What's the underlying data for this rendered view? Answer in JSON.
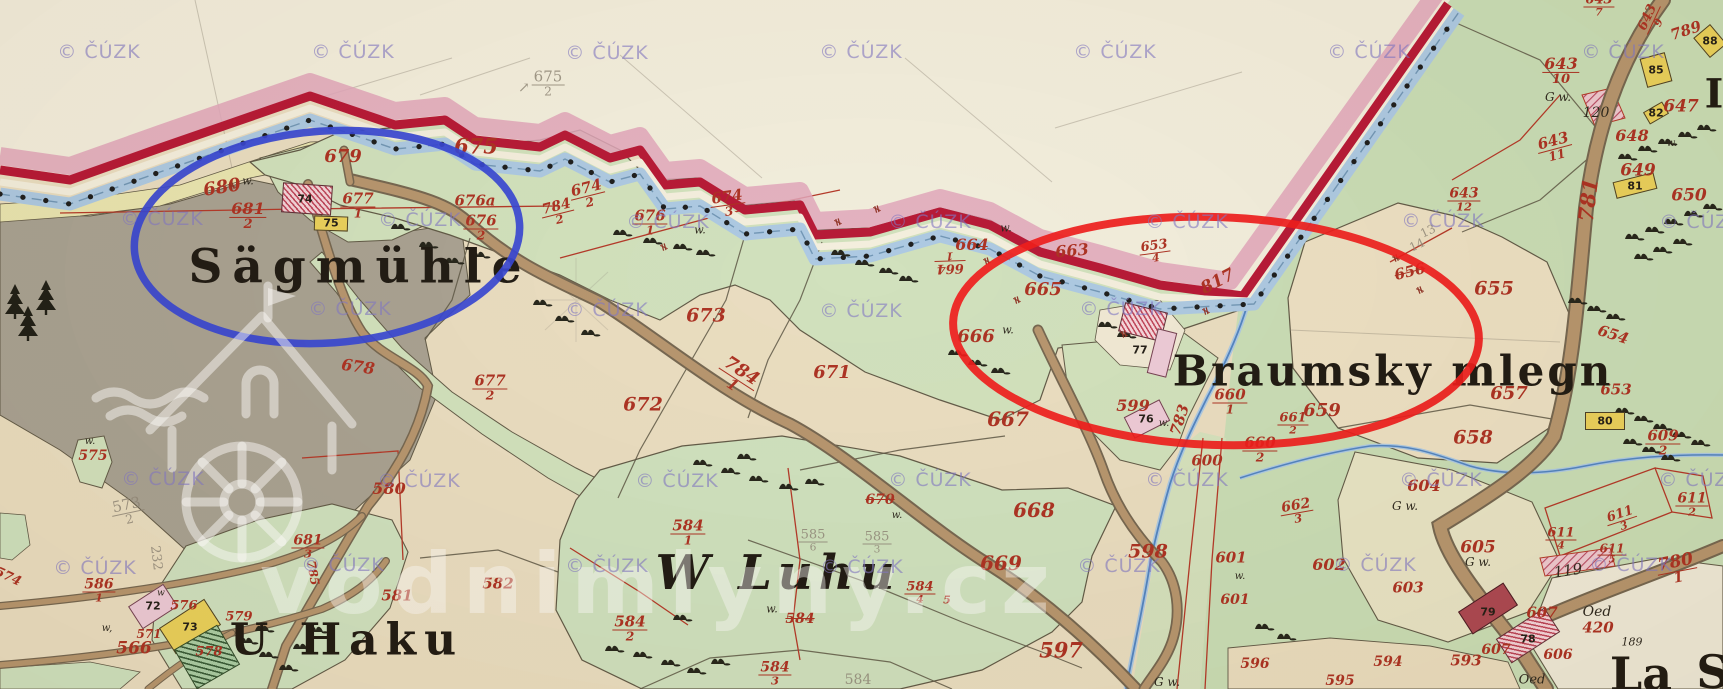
{
  "map": {
    "description": "historical cadastral map sheet with stream boundary, meadows, roads and farmsteads"
  },
  "watermark": {
    "copyright": "© ČÚZK",
    "site": "vodnimlyny.cz",
    "copyright_positions": [
      [
        99,
        52
      ],
      [
        353,
        52
      ],
      [
        607,
        53
      ],
      [
        861,
        52
      ],
      [
        1115,
        52
      ],
      [
        1369,
        52
      ],
      [
        1623,
        52
      ],
      [
        162,
        219
      ],
      [
        420,
        220
      ],
      [
        668,
        222
      ],
      [
        930,
        222
      ],
      [
        1187,
        222
      ],
      [
        1443,
        221
      ],
      [
        1701,
        222
      ],
      [
        350,
        309
      ],
      [
        607,
        310
      ],
      [
        861,
        311
      ],
      [
        1121,
        309
      ],
      [
        163,
        479
      ],
      [
        419,
        481
      ],
      [
        677,
        481
      ],
      [
        930,
        480
      ],
      [
        1187,
        480
      ],
      [
        1441,
        480
      ],
      [
        1700,
        480
      ],
      [
        95,
        568
      ],
      [
        343,
        565
      ],
      [
        607,
        566
      ],
      [
        862,
        567
      ],
      [
        1119,
        566
      ],
      [
        1375,
        565
      ],
      [
        1631,
        565
      ]
    ]
  },
  "annotations": {
    "blue_ellipse": {
      "cx": 327,
      "cy": 237,
      "rx": 193,
      "ry": 106,
      "rot": -4,
      "color": "#2e3ed2",
      "width": 7.5
    },
    "red_ellipse": {
      "cx": 1216,
      "cy": 331,
      "rx": 263,
      "ry": 114,
      "rot": 2,
      "color": "#ee1212",
      "width": 8
    }
  },
  "colors": {
    "paper_outside": "#f2eddc",
    "paper_field": "#e9dcbf",
    "meadow_green": "#cfe0bb",
    "village_green": "#c7dcb4",
    "forest_gray": "#a59e8f",
    "boundary_crimson": "#b30f2e",
    "boundary_pink": "#dfa2b8",
    "stream_blue": "#a9c7e2",
    "road_brown": "#b39169",
    "parcel_red": "#a8291a",
    "pencil_gray": "#8b8374",
    "ink_black": "#221d14"
  },
  "place_names": [
    {
      "text": "Sägmühle",
      "x": 360,
      "y": 267,
      "size": 47,
      "ls": 10
    },
    {
      "text": "Braumsky mlegn",
      "x": 1393,
      "y": 371,
      "size": 42,
      "ls": 3
    },
    {
      "text": "U Haku",
      "x": 347,
      "y": 640,
      "size": 44,
      "ls": 8
    },
    {
      "text": "W Luhu",
      "x": 778,
      "y": 573,
      "size": 48,
      "ls": 6,
      "style": "script"
    },
    {
      "text": "La",
      "x": 1641,
      "y": 674,
      "size": 46
    },
    {
      "text": "S",
      "x": 1713,
      "y": 672,
      "size": 46
    },
    {
      "text": "I",
      "x": 1714,
      "y": 94,
      "size": 40
    }
  ],
  "parcel_labels": [
    {
      "n": "675",
      "d": "2",
      "x": 548,
      "y": 84,
      "c": "pencil",
      "s": 15
    },
    {
      "t": "↗",
      "x": 524,
      "y": 88,
      "c": "pencil",
      "s": 14
    },
    {
      "t": "675",
      "x": 476,
      "y": 146,
      "s": 21
    },
    {
      "t": "679",
      "x": 343,
      "y": 157,
      "s": 18
    },
    {
      "t": "680",
      "x": 222,
      "y": 188,
      "r": -9,
      "s": 18
    },
    {
      "t": "w.",
      "x": 248,
      "y": 181,
      "c": "black",
      "s": 11
    },
    {
      "n": "681",
      "d": "2",
      "x": 248,
      "y": 216,
      "s": 16
    },
    {
      "n": "677",
      "d": "1",
      "x": 358,
      "y": 206,
      "s": 15
    },
    {
      "t": "676a",
      "x": 475,
      "y": 201,
      "s": 15
    },
    {
      "n": "676",
      "d": "2",
      "x": 481,
      "y": 228,
      "s": 15
    },
    {
      "n": "676",
      "d": "1",
      "x": 650,
      "y": 223,
      "s": 15
    },
    {
      "t": "w.",
      "x": 700,
      "y": 230,
      "c": "black",
      "s": 11
    },
    {
      "n": "674",
      "d": "2",
      "x": 588,
      "y": 195,
      "r": -14,
      "s": 15
    },
    {
      "n": "784",
      "d": "2",
      "x": 558,
      "y": 213,
      "r": -14,
      "s": 14
    },
    {
      "n": "674",
      "d": "3",
      "x": 728,
      "y": 204,
      "r": -8,
      "s": 15
    },
    {
      "t": "678",
      "x": 358,
      "y": 367,
      "r": 8,
      "s": 16
    },
    {
      "n": "677",
      "d": "2",
      "x": 490,
      "y": 388,
      "s": 15
    },
    {
      "t": "673",
      "x": 706,
      "y": 316,
      "s": 19
    },
    {
      "t": "672",
      "x": 643,
      "y": 405,
      "s": 19
    },
    {
      "t": "671",
      "x": 832,
      "y": 373,
      "s": 18
    },
    {
      "n": "784",
      "d": "1",
      "x": 737,
      "y": 378,
      "r": 33,
      "s": 18
    },
    {
      "t": "663",
      "x": 1072,
      "y": 251,
      "r": -5,
      "s": 16
    },
    {
      "t": "664",
      "x": 972,
      "y": 245,
      "s": 16
    },
    {
      "n": "664",
      "d": "1",
      "x": 950,
      "y": 262,
      "r": 178,
      "s": 13
    },
    {
      "n": "653",
      "d": "4",
      "x": 1155,
      "y": 252,
      "r": -8,
      "s": 13
    },
    {
      "t": "665",
      "x": 1043,
      "y": 290,
      "s": 18
    },
    {
      "t": "817",
      "x": 1218,
      "y": 282,
      "r": -27,
      "s": 17
    },
    {
      "t": "666",
      "x": 976,
      "y": 337,
      "s": 18
    },
    {
      "t": "w.",
      "x": 1008,
      "y": 330,
      "c": "black",
      "s": 11
    },
    {
      "t": "w.",
      "x": 1006,
      "y": 228,
      "c": "black",
      "s": 11
    },
    {
      "t": "667",
      "x": 1008,
      "y": 419,
      "s": 20
    },
    {
      "t": "668",
      "x": 1034,
      "y": 510,
      "s": 20
    },
    {
      "t": "669",
      "x": 1001,
      "y": 563,
      "s": 20
    },
    {
      "t": "597",
      "x": 1061,
      "y": 650,
      "s": 21
    },
    {
      "t": "598",
      "x": 1148,
      "y": 552,
      "s": 19
    },
    {
      "t": "599",
      "x": 1133,
      "y": 406,
      "s": 16
    },
    {
      "t": "783",
      "x": 1180,
      "y": 420,
      "r": -72,
      "s": 15
    },
    {
      "n": "660",
      "d": "1",
      "x": 1230,
      "y": 402,
      "s": 15
    },
    {
      "n": "660",
      "d": "2",
      "x": 1260,
      "y": 450,
      "s": 15
    },
    {
      "n": "661",
      "d": "2",
      "x": 1293,
      "y": 424,
      "s": 13
    },
    {
      "n": "662",
      "d": "3",
      "x": 1297,
      "y": 512,
      "r": -10,
      "s": 14
    },
    {
      "t": "659",
      "x": 1322,
      "y": 411,
      "s": 18
    },
    {
      "t": "658",
      "x": 1473,
      "y": 438,
      "s": 19
    },
    {
      "t": "657",
      "x": 1509,
      "y": 394,
      "s": 18
    },
    {
      "t": "655",
      "x": 1494,
      "y": 289,
      "s": 19
    },
    {
      "t": "656",
      "x": 1410,
      "y": 272,
      "r": -14,
      "s": 15,
      "k": "struck"
    },
    {
      "t": "654",
      "x": 1613,
      "y": 335,
      "r": 18,
      "s": 15
    },
    {
      "t": "653",
      "x": 1616,
      "y": 390,
      "s": 15
    },
    {
      "t": "649",
      "x": 1638,
      "y": 171,
      "s": 17
    },
    {
      "t": "650",
      "x": 1689,
      "y": 196,
      "s": 17
    },
    {
      "t": "647",
      "x": 1681,
      "y": 107,
      "s": 17
    },
    {
      "t": "648",
      "x": 1632,
      "y": 136,
      "s": 16
    },
    {
      "t": "w.",
      "x": 1672,
      "y": 144,
      "c": "black",
      "s": 10
    },
    {
      "n": "643",
      "d": "10",
      "x": 1561,
      "y": 71,
      "s": 16
    },
    {
      "t": "G w.",
      "x": 1558,
      "y": 97,
      "c": "black",
      "s": 12
    },
    {
      "t": "120",
      "x": 1596,
      "y": 113,
      "c": "black",
      "s": 14
    },
    {
      "n": "643",
      "d": "11",
      "x": 1555,
      "y": 148,
      "r": -15,
      "s": 15
    },
    {
      "n": "643",
      "d": "12",
      "x": 1464,
      "y": 200,
      "s": 14
    },
    {
      "n": "643",
      "d": "9",
      "x": 1653,
      "y": 20,
      "r": -65,
      "s": 13
    },
    {
      "n": "643",
      "d": "7",
      "x": 1599,
      "y": 6,
      "s": 13
    },
    {
      "t": "789",
      "x": 1686,
      "y": 31,
      "r": -18,
      "s": 15
    },
    {
      "t": "13",
      "x": 1428,
      "y": 231,
      "r": -25,
      "c": "pencil",
      "s": 12
    },
    {
      "t": "14",
      "x": 1417,
      "y": 245,
      "r": -25,
      "c": "pencil",
      "s": 12
    },
    {
      "t": "781",
      "x": 1588,
      "y": 200,
      "r": -83,
      "s": 21
    },
    {
      "n": "780",
      "d": "1",
      "x": 1677,
      "y": 570,
      "r": -11,
      "s": 17
    },
    {
      "t": "604",
      "x": 1424,
      "y": 486,
      "s": 16
    },
    {
      "t": "G w.",
      "x": 1405,
      "y": 506,
      "c": "black",
      "s": 12
    },
    {
      "t": "605",
      "x": 1478,
      "y": 548,
      "s": 17
    },
    {
      "t": "G w.",
      "x": 1478,
      "y": 562,
      "c": "black",
      "s": 12
    },
    {
      "t": "603",
      "x": 1408,
      "y": 588,
      "s": 15
    },
    {
      "n": "609",
      "d": "2",
      "x": 1663,
      "y": 443,
      "s": 15
    },
    {
      "n": "611",
      "d": "2",
      "x": 1692,
      "y": 505,
      "s": 14
    },
    {
      "n": "611",
      "d": "3",
      "x": 1622,
      "y": 520,
      "r": -18,
      "s": 13
    },
    {
      "n": "611",
      "d": "4",
      "x": 1561,
      "y": 539,
      "s": 13
    },
    {
      "n": "611",
      "d": "5",
      "x": 1612,
      "y": 554,
      "s": 12
    },
    {
      "t": "119",
      "x": 1568,
      "y": 571,
      "r": -8,
      "c": "black",
      "s": 15
    },
    {
      "t": "Oed",
      "x": 1597,
      "y": 612,
      "c": "black",
      "s": 14
    },
    {
      "t": "420",
      "x": 1598,
      "y": 628,
      "s": 15
    },
    {
      "t": "189",
      "x": 1632,
      "y": 642,
      "c": "black",
      "s": 11
    },
    {
      "t": "Oed",
      "x": 1532,
      "y": 680,
      "c": "black",
      "s": 13
    },
    {
      "t": "607",
      "x": 1542,
      "y": 613,
      "s": 15
    },
    {
      "t": "607",
      "x": 1496,
      "y": 650,
      "s": 14
    },
    {
      "t": "606",
      "x": 1558,
      "y": 655,
      "s": 14
    },
    {
      "t": "593",
      "x": 1466,
      "y": 661,
      "s": 15
    },
    {
      "t": "594",
      "x": 1388,
      "y": 662,
      "s": 14
    },
    {
      "t": "595",
      "x": 1340,
      "y": 681,
      "s": 14
    },
    {
      "t": "596",
      "x": 1255,
      "y": 664,
      "s": 14
    },
    {
      "t": "G w.",
      "x": 1167,
      "y": 682,
      "c": "black",
      "s": 12
    },
    {
      "t": "602",
      "x": 1329,
      "y": 565,
      "s": 16
    },
    {
      "t": "601",
      "x": 1231,
      "y": 558,
      "s": 15
    },
    {
      "t": "601",
      "x": 1235,
      "y": 600,
      "s": 14
    },
    {
      "t": "w.",
      "x": 1240,
      "y": 577,
      "c": "black",
      "s": 10
    },
    {
      "t": "600",
      "x": 1207,
      "y": 461,
      "s": 15
    },
    {
      "t": "w.",
      "x": 1164,
      "y": 424,
      "c": "black",
      "s": 10
    },
    {
      "n": "681",
      "d": "3",
      "x": 308,
      "y": 547,
      "s": 14
    },
    {
      "t": "785",
      "x": 313,
      "y": 573,
      "r": 80,
      "s": 12
    },
    {
      "t": "580",
      "x": 389,
      "y": 489,
      "s": 16
    },
    {
      "t": "581",
      "x": 397,
      "y": 596,
      "s": 15
    },
    {
      "t": "582",
      "x": 498,
      "y": 584,
      "s": 15
    },
    {
      "t": "566",
      "x": 134,
      "y": 649,
      "s": 17
    },
    {
      "t": "571",
      "x": 149,
      "y": 634,
      "s": 12
    },
    {
      "t": "576",
      "x": 184,
      "y": 606,
      "s": 13
    },
    {
      "t": "578",
      "x": 209,
      "y": 652,
      "s": 13
    },
    {
      "t": "579",
      "x": 239,
      "y": 617,
      "s": 13
    },
    {
      "n": "586",
      "d": "1",
      "x": 99,
      "y": 591,
      "s": 14
    },
    {
      "t": "575",
      "x": 93,
      "y": 456,
      "s": 14
    },
    {
      "t": "w.",
      "x": 90,
      "y": 442,
      "c": "black",
      "s": 10
    },
    {
      "t": "w,",
      "x": 107,
      "y": 629,
      "c": "black",
      "s": 10
    },
    {
      "t": "w",
      "x": 161,
      "y": 594,
      "c": "black",
      "s": 9
    },
    {
      "t": "574",
      "x": 8,
      "y": 577,
      "r": 25,
      "s": 13
    },
    {
      "n": "573",
      "d": "2",
      "x": 128,
      "y": 512,
      "r": -12,
      "c": "pencil",
      "s": 15
    },
    {
      "t": "232",
      "x": 156,
      "y": 558,
      "r": 83,
      "c": "pencil",
      "s": 13
    },
    {
      "n": "584",
      "d": "1",
      "x": 688,
      "y": 533,
      "s": 15
    },
    {
      "n": "584",
      "d": "2",
      "x": 630,
      "y": 629,
      "s": 15
    },
    {
      "n": "584",
      "d": "3",
      "x": 775,
      "y": 674,
      "s": 14
    },
    {
      "t": "584",
      "x": 800,
      "y": 619,
      "s": 14,
      "k": "struck"
    },
    {
      "n": "584",
      "d": "4",
      "x": 920,
      "y": 593,
      "s": 13
    },
    {
      "t": "5",
      "x": 947,
      "y": 600,
      "s": 11
    },
    {
      "t": "584",
      "x": 858,
      "y": 680,
      "c": "pencil",
      "s": 14
    },
    {
      "n": "585",
      "d": "6",
      "x": 813,
      "y": 541,
      "c": "pencil",
      "s": 13
    },
    {
      "n": "585",
      "d": "3",
      "x": 877,
      "y": 543,
      "c": "pencil",
      "s": 13
    },
    {
      "t": "670",
      "x": 880,
      "y": 500,
      "s": 14,
      "k": "struck"
    },
    {
      "t": "w.",
      "x": 897,
      "y": 516,
      "c": "black",
      "s": 10
    },
    {
      "t": "w.",
      "x": 772,
      "y": 609,
      "c": "black",
      "s": 11
    },
    {
      "t": "≠",
      "x": 838,
      "y": 222,
      "r": 75,
      "c": "tick",
      "s": 11
    },
    {
      "t": "≠",
      "x": 877,
      "y": 209,
      "r": 75,
      "c": "tick",
      "s": 11
    },
    {
      "t": "≠",
      "x": 987,
      "y": 261,
      "r": 75,
      "c": "tick",
      "s": 11
    },
    {
      "t": "≠",
      "x": 1017,
      "y": 300,
      "r": 75,
      "c": "tick",
      "s": 11
    },
    {
      "t": "≠",
      "x": 232,
      "y": 186,
      "r": 70,
      "c": "tick",
      "s": 11
    },
    {
      "t": "≠",
      "x": 664,
      "y": 247,
      "r": 75,
      "c": "tick",
      "s": 11
    },
    {
      "t": "≠",
      "x": 1124,
      "y": 334,
      "r": 75,
      "c": "tick",
      "s": 11
    },
    {
      "t": "≠",
      "x": 1206,
      "y": 311,
      "r": 75,
      "c": "tick",
      "s": 11
    },
    {
      "t": "≠",
      "x": 1396,
      "y": 258,
      "r": 70,
      "c": "tick",
      "s": 11
    },
    {
      "t": "≠",
      "x": 1420,
      "y": 290,
      "r": 70,
      "c": "tick",
      "s": 11
    }
  ],
  "houses": [
    {
      "num": "74",
      "x": 282,
      "y": 184,
      "w": 50,
      "h": 30,
      "r": 4,
      "k": "hatch",
      "nx": 305,
      "ny": 199
    },
    {
      "num": "75",
      "x": 314,
      "y": 216,
      "w": 34,
      "h": 15,
      "r": 2,
      "k": "yellow",
      "nx": 331,
      "ny": 223
    },
    {
      "num": "77",
      "x": 1121,
      "y": 307,
      "w": 44,
      "h": 30,
      "r": 14,
      "k": "hatch",
      "nx": 1140,
      "ny": 350
    },
    {
      "num": "",
      "x": 1152,
      "y": 330,
      "w": 20,
      "h": 46,
      "r": 14,
      "k": "pink"
    },
    {
      "num": "76",
      "x": 1127,
      "y": 407,
      "w": 40,
      "h": 24,
      "r": -27,
      "k": "pink",
      "nx": 1146,
      "ny": 419
    },
    {
      "num": "72",
      "x": 132,
      "y": 593,
      "w": 42,
      "h": 27,
      "r": -33,
      "k": "pink",
      "nx": 153,
      "ny": 606
    },
    {
      "num": "73",
      "x": 163,
      "y": 611,
      "w": 54,
      "h": 31,
      "r": -33,
      "k": "yellow",
      "nx": 190,
      "ny": 627
    },
    {
      "num": "",
      "x": 182,
      "y": 634,
      "w": 50,
      "h": 46,
      "r": -30,
      "k": "ghatch"
    },
    {
      "num": "85",
      "x": 1643,
      "y": 55,
      "w": 26,
      "h": 30,
      "r": -15,
      "k": "yellow",
      "nx": 1656,
      "ny": 70
    },
    {
      "num": "82",
      "x": 1645,
      "y": 106,
      "w": 22,
      "h": 14,
      "r": -30,
      "k": "yellow",
      "nx": 1656,
      "ny": 113
    },
    {
      "num": "81",
      "x": 1614,
      "y": 177,
      "w": 42,
      "h": 17,
      "r": -14,
      "k": "yellow",
      "nx": 1635,
      "ny": 186
    },
    {
      "num": "80",
      "x": 1585,
      "y": 412,
      "w": 40,
      "h": 18,
      "r": 0,
      "k": "yellow",
      "nx": 1605,
      "ny": 421
    },
    {
      "num": "88",
      "x": 1699,
      "y": 28,
      "w": 22,
      "h": 26,
      "r": -40,
      "k": "yellow",
      "nx": 1710,
      "ny": 41
    },
    {
      "num": "79",
      "x": 1461,
      "y": 595,
      "w": 54,
      "h": 27,
      "r": -33,
      "k": "solid",
      "nx": 1488,
      "ny": 612
    },
    {
      "num": "78",
      "x": 1499,
      "y": 621,
      "w": 58,
      "h": 29,
      "r": -33,
      "k": "hatch",
      "nx": 1528,
      "ny": 639
    }
  ]
}
